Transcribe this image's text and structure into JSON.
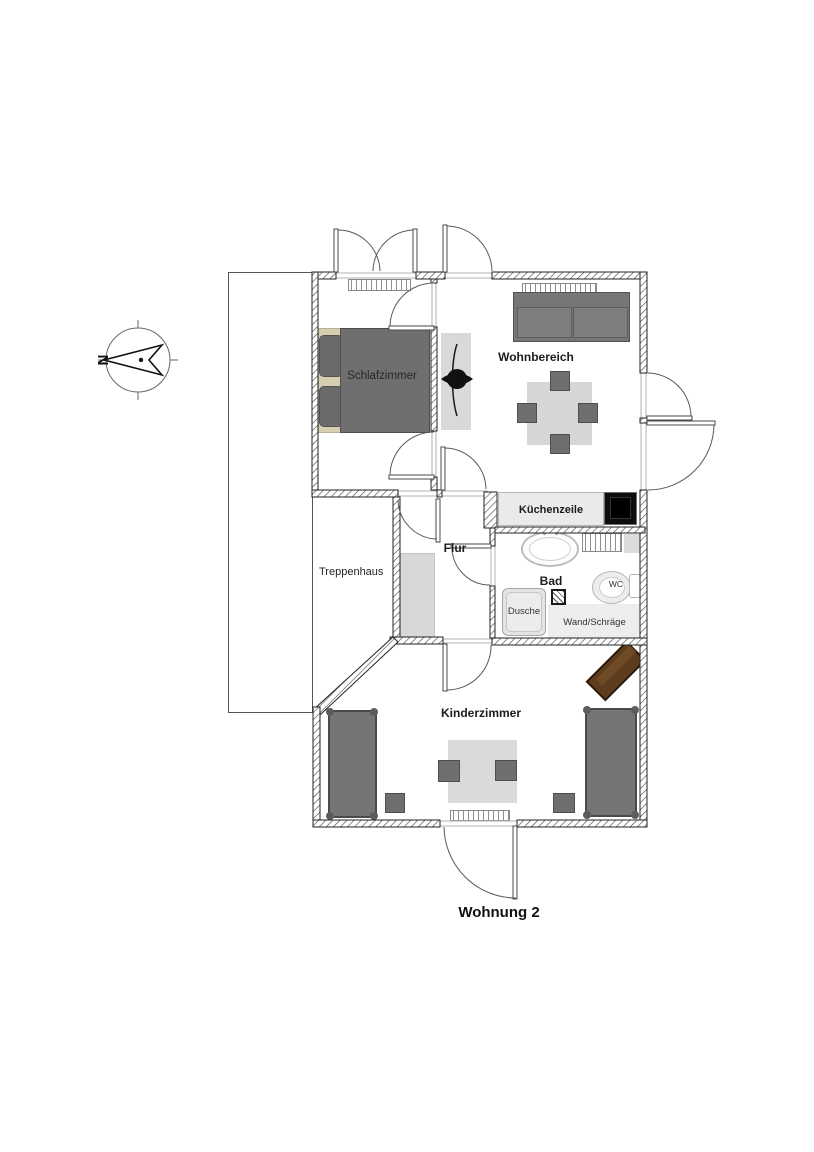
{
  "title": "Wohnung 2",
  "compass": {
    "north_letter": "N"
  },
  "rooms": {
    "schlafzimmer": "Schlafzimmer",
    "wohnbereich": "Wohnbereich",
    "kuechenzeile": "Küchenzeile",
    "flur": "Flur",
    "bad": "Bad",
    "treppenhaus": "Treppenhaus",
    "kinderzimmer": "Kinderzimmer"
  },
  "fixtures": {
    "wc": "WC",
    "dusche": "Dusche",
    "wand_schraege": "Wand/Schräge"
  },
  "colors": {
    "wall_hatch": "#5a5a5a",
    "furniture_dark": "#6f6f6f",
    "furniture_light": "#d9d9d9",
    "stove_black": "#0d0d0d",
    "desk_brown": "#5d3d1e",
    "pillow_beige": "#d8cfb2"
  }
}
